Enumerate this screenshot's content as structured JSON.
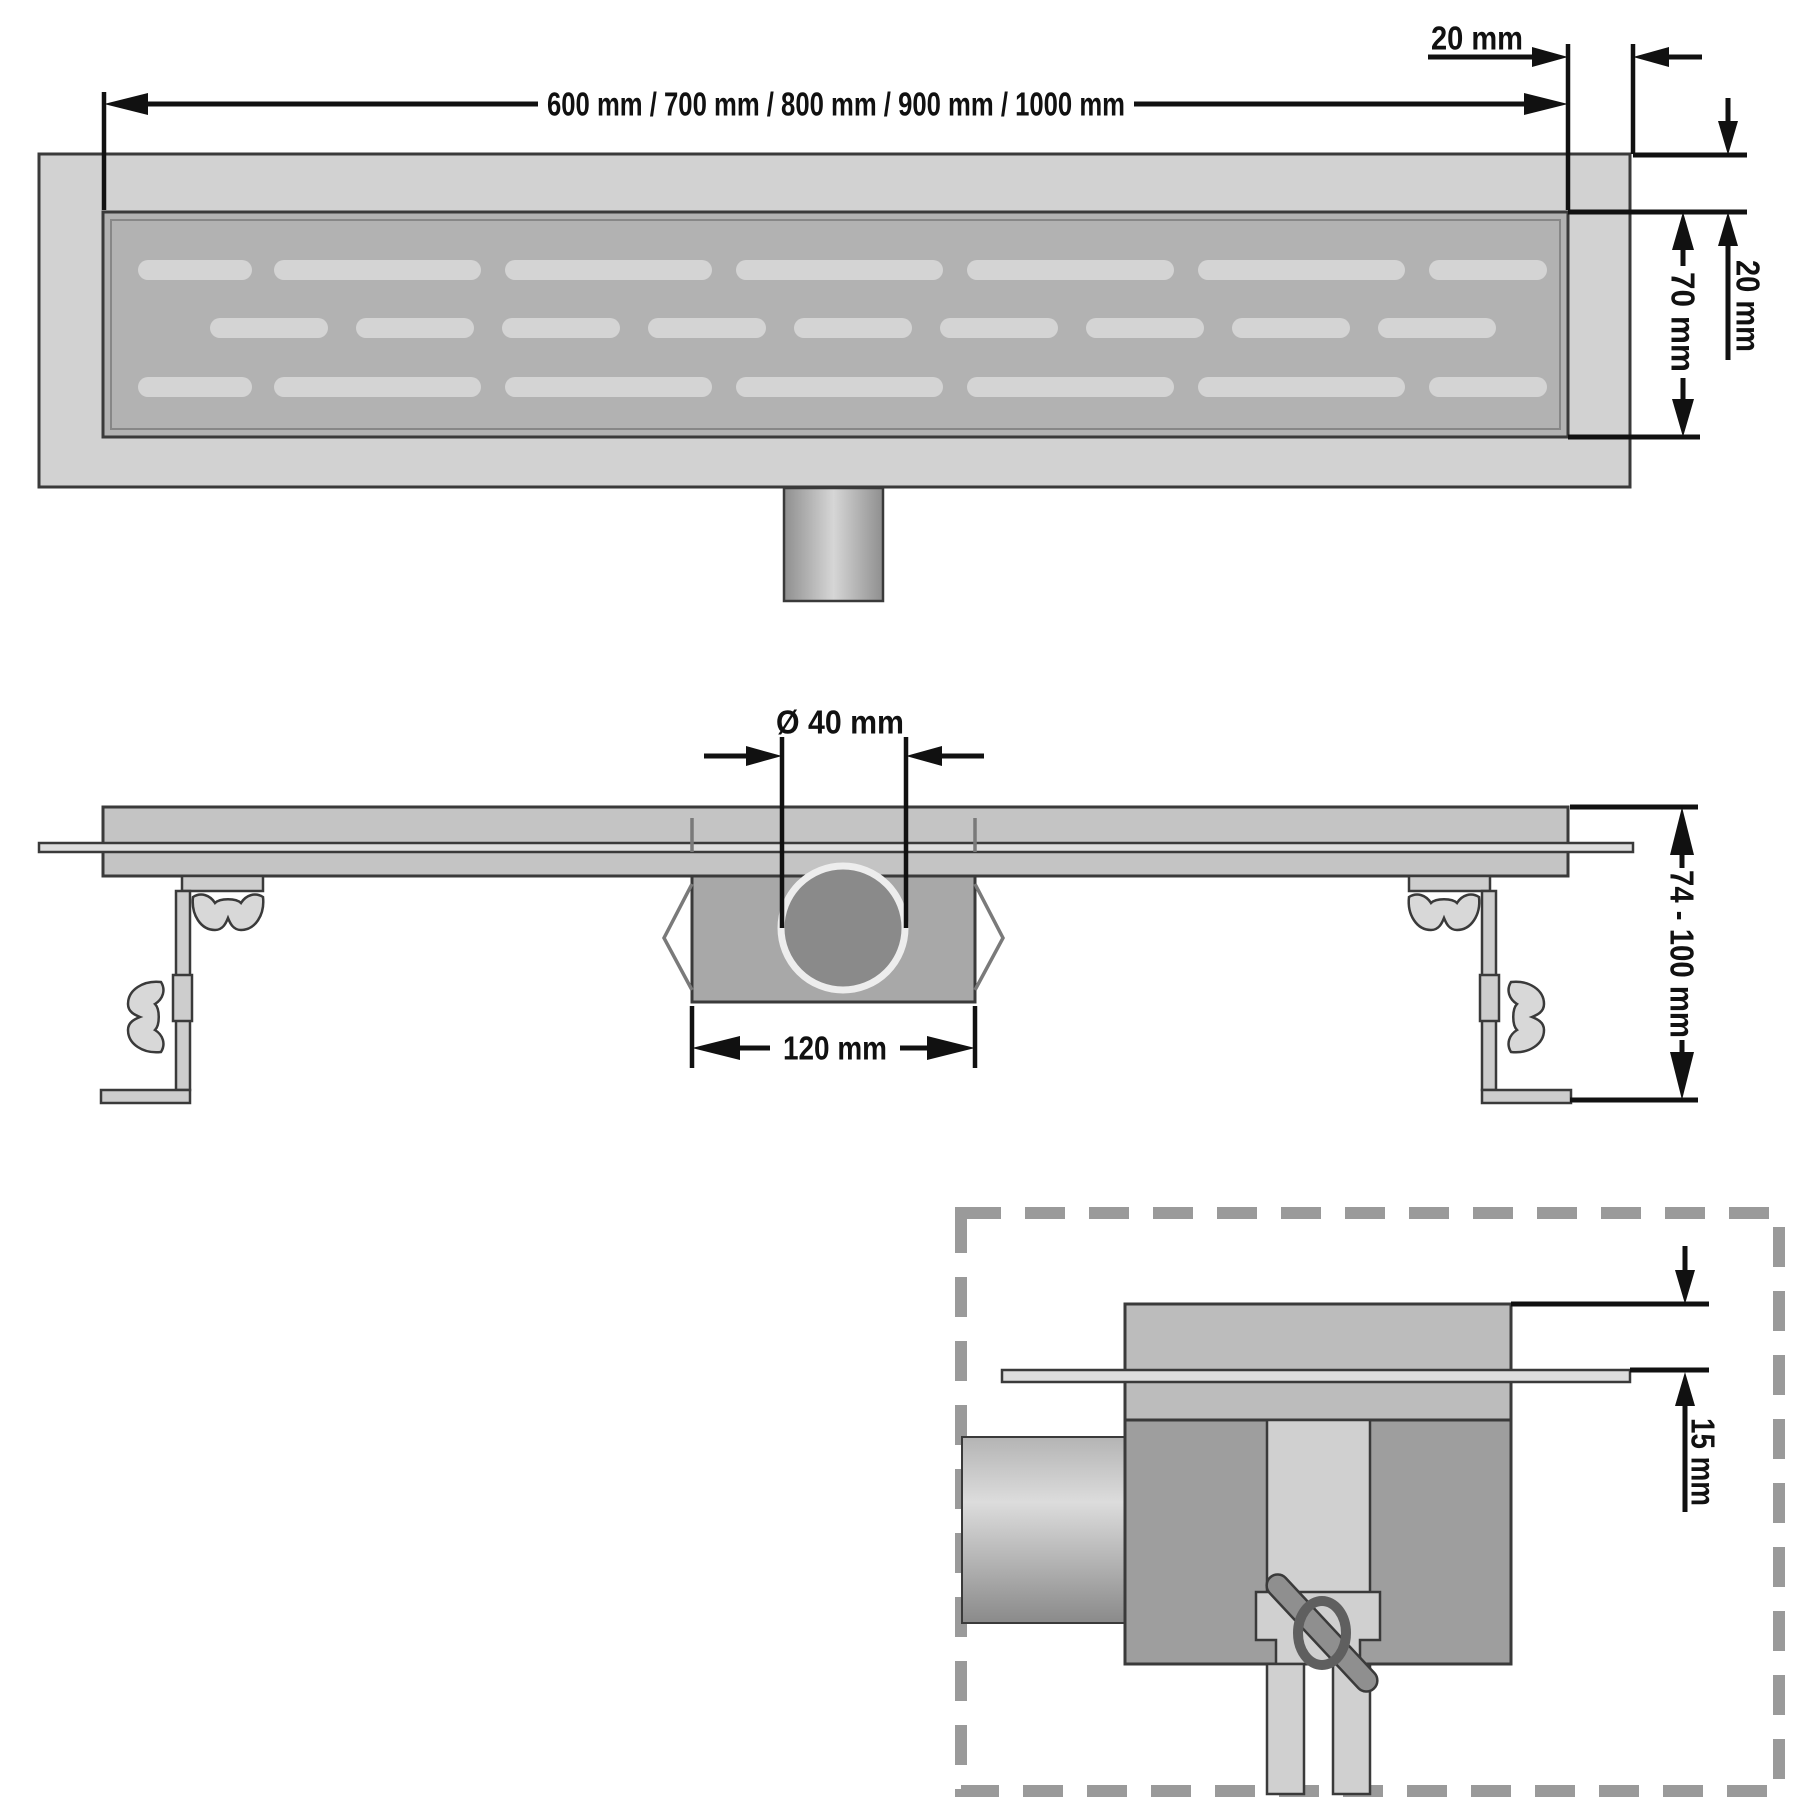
{
  "colors": {
    "background": "#ffffff",
    "frame": "#d2d2d2",
    "grate": "#b2b2b2",
    "slot": "#d4d4d4",
    "channel": "#c4c4c4",
    "flange": "#dedede",
    "trap": "#a8a8a8",
    "pipe": "#8a8a8a",
    "pipe_ring": "#ededed",
    "pipe_edge": "#8f8f8f",
    "pipe_center": "#d6d6d6",
    "bracket": "#cdcdcd",
    "wingnut": "#d8d8d8",
    "detail_upper": "#bcbcbc",
    "detail_lower": "#9e9e9e",
    "detail_pipe_top": "#b4b4b4",
    "detail_pipe_mid": "#dcdcdc",
    "detail_pipe_bottom": "#8a8a8a",
    "standpipe": "#d0d0d0",
    "bolt_handle": "#8f8f8f",
    "bolt_ring": "#5f5f5f",
    "dashed_border": "#9a9a9a",
    "dimension": "#111111"
  },
  "dimensions": {
    "length_options": "600 mm / 700 mm / 800 mm / 900 mm / 1000 mm",
    "edge_width_top": "20 mm",
    "edge_width_side": "20 mm",
    "grate_width": "70 mm",
    "pipe_diameter": "Ø 40 mm",
    "trap_width": "120 mm",
    "installation_height": "74 - 100 mm",
    "flange_reveal": "15 mm"
  },
  "grate_slots": {
    "pill_height": 20,
    "radius": 10,
    "rows": [
      {
        "y": 260,
        "pills": [
          [
            138,
            114
          ],
          [
            274,
            207
          ],
          [
            505,
            207
          ],
          [
            736,
            207
          ],
          [
            967,
            207
          ],
          [
            1198,
            207
          ],
          [
            1429,
            118
          ]
        ]
      },
      {
        "y": 318,
        "pills": [
          [
            210,
            118
          ],
          [
            356,
            118
          ],
          [
            502,
            118
          ],
          [
            648,
            118
          ],
          [
            794,
            118
          ],
          [
            940,
            118
          ],
          [
            1086,
            118
          ],
          [
            1232,
            118
          ],
          [
            1378,
            118
          ]
        ]
      },
      {
        "y": 377,
        "pills": [
          [
            138,
            114
          ],
          [
            274,
            207
          ],
          [
            505,
            207
          ],
          [
            736,
            207
          ],
          [
            967,
            207
          ],
          [
            1198,
            207
          ],
          [
            1429,
            118
          ]
        ]
      }
    ]
  }
}
